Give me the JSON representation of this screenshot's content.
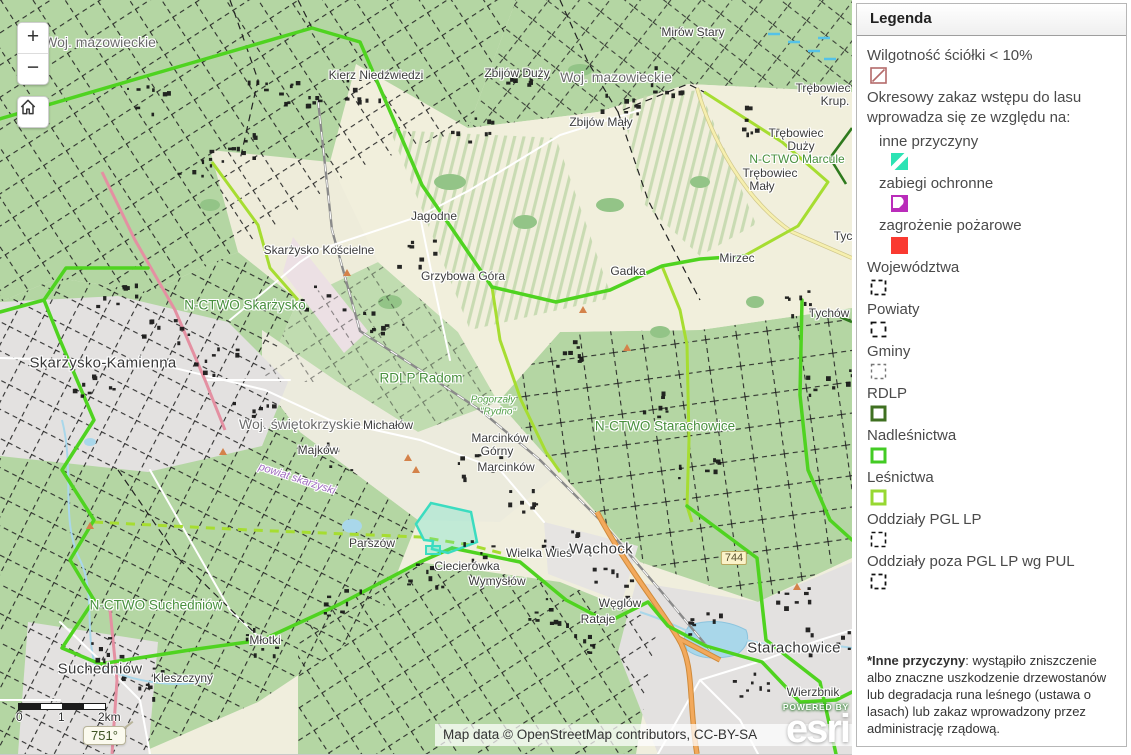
{
  "map": {
    "controls": {
      "zoom_in_label": "+",
      "zoom_out_label": "−"
    },
    "scalebar": {
      "ticks": [
        "0",
        "1",
        "2km"
      ]
    },
    "readout": "751°",
    "attribution": "Map data © OpenStreetMap contributors, CC-BY-SA",
    "powered_by": "POWERED BY",
    "brand": "esri",
    "labels": [
      {
        "text": "Woj. mazowieckie",
        "x": 100,
        "y": 42,
        "cls": "admin"
      },
      {
        "text": "Mirów Stary",
        "x": 693,
        "y": 32,
        "cls": "place"
      },
      {
        "text": "Kierz Niedźwiedzi",
        "x": 376,
        "y": 75,
        "cls": "place"
      },
      {
        "text": "Zbijów Duży",
        "x": 517,
        "y": 73,
        "cls": "place"
      },
      {
        "text": "Woj. mazowieckie",
        "x": 616,
        "y": 77,
        "cls": "admin"
      },
      {
        "text": "Zbijów Mały",
        "x": 601,
        "y": 122,
        "cls": "place"
      },
      {
        "text": "Trębowiec",
        "x": 823,
        "y": 88,
        "cls": "place"
      },
      {
        "text": "Krup.",
        "x": 835,
        "y": 101,
        "cls": "place"
      },
      {
        "text": "Trębowiec",
        "x": 796,
        "y": 133,
        "cls": "place"
      },
      {
        "text": "Duży",
        "x": 801,
        "y": 146,
        "cls": "place"
      },
      {
        "text": "N-CTWO Marcule",
        "x": 797,
        "y": 159,
        "cls": "forest"
      },
      {
        "text": "Trębowiec",
        "x": 770,
        "y": 173,
        "cls": "place"
      },
      {
        "text": "Mały",
        "x": 762,
        "y": 186,
        "cls": "place"
      },
      {
        "text": "Jagodne",
        "x": 434,
        "y": 216,
        "cls": "place"
      },
      {
        "text": "Tyc",
        "x": 843,
        "y": 236,
        "cls": "place"
      },
      {
        "text": "Skarżysko Kościelne",
        "x": 319,
        "y": 250,
        "cls": "place"
      },
      {
        "text": "Mirzec",
        "x": 737,
        "y": 258,
        "cls": "place"
      },
      {
        "text": "Gadka",
        "x": 628,
        "y": 271,
        "cls": "place"
      },
      {
        "text": "Grzybowa Góra",
        "x": 463,
        "y": 276,
        "cls": "place"
      },
      {
        "text": "N-CTWO Skarżysko",
        "x": 245,
        "y": 305,
        "cls": "forest-lg"
      },
      {
        "text": "Tychów",
        "x": 829,
        "y": 313,
        "cls": "place"
      },
      {
        "text": "Skarżysko-Kamienna",
        "x": 103,
        "y": 363,
        "cls": "city"
      },
      {
        "text": "RDLP Radom",
        "x": 421,
        "y": 378,
        "cls": "forest-lg"
      },
      {
        "text": "Pogorzały",
        "x": 493,
        "y": 400,
        "cls": "reserve"
      },
      {
        "text": "\"Rydno\"",
        "x": 498,
        "y": 412,
        "cls": "reserve"
      },
      {
        "text": "Woj. świętokrzyskie",
        "x": 300,
        "y": 424,
        "cls": "admin"
      },
      {
        "text": "Michałów",
        "x": 388,
        "y": 425,
        "cls": "place"
      },
      {
        "text": "N-CTWO Starachowice",
        "x": 665,
        "y": 426,
        "cls": "forest-lg"
      },
      {
        "text": "Marcinków",
        "x": 500,
        "y": 438,
        "cls": "place"
      },
      {
        "text": "Górny",
        "x": 497,
        "y": 451,
        "cls": "place"
      },
      {
        "text": "Majków",
        "x": 318,
        "y": 450,
        "cls": "place"
      },
      {
        "text": "Marcinków",
        "x": 506,
        "y": 467,
        "cls": "place"
      },
      {
        "text": "powiat skarżyski",
        "x": 297,
        "y": 479,
        "cls": "powiat",
        "rot": 18
      },
      {
        "text": "Parszów",
        "x": 372,
        "y": 543,
        "cls": "place"
      },
      {
        "text": "Wielka Wieś",
        "x": 539,
        "y": 553,
        "cls": "place"
      },
      {
        "text": "Wąchock",
        "x": 601,
        "y": 549,
        "cls": "city"
      },
      {
        "text": "Ciecierówka",
        "x": 467,
        "y": 566,
        "cls": "place"
      },
      {
        "text": "Wymysłów",
        "x": 497,
        "y": 581,
        "cls": "place"
      },
      {
        "text": "N-CTWO Suchedniów",
        "x": 156,
        "y": 605,
        "cls": "forest-lg"
      },
      {
        "text": "Węglów",
        "x": 620,
        "y": 603,
        "cls": "place"
      },
      {
        "text": "Rataje",
        "x": 598,
        "y": 619,
        "cls": "place"
      },
      {
        "text": "Młotki",
        "x": 265,
        "y": 640,
        "cls": "place"
      },
      {
        "text": "Suchedniów",
        "x": 100,
        "y": 669,
        "cls": "city"
      },
      {
        "text": "Kleszczyny",
        "x": 183,
        "y": 678,
        "cls": "place"
      },
      {
        "text": "Starachowice",
        "x": 794,
        "y": 648,
        "cls": "city"
      },
      {
        "text": "Wierzbnik",
        "x": 813,
        "y": 692,
        "cls": "place"
      },
      {
        "text": "744",
        "x": 734,
        "y": 558,
        "cls": "shield"
      }
    ]
  },
  "legend": {
    "title": "Legenda",
    "items": [
      {
        "label": "Wilgotność ściółki < 10%",
        "swatch": {
          "kind": "diag-line",
          "color": "#b46a6a"
        }
      },
      {
        "label": "Okresowy zakaz wstępu do lasu wprowadza się ze względu na:",
        "swatch": null
      },
      {
        "label": "inne przyczyny",
        "indent": true,
        "swatch": {
          "kind": "stripe",
          "color": "#2ce3b4"
        }
      },
      {
        "label": "zabiegi ochronne",
        "indent": true,
        "swatch": {
          "kind": "corner",
          "color": "#ba2cba"
        }
      },
      {
        "label": "zagrożenie pożarowe",
        "indent": true,
        "swatch": {
          "kind": "fill",
          "color": "#fa3a31"
        }
      },
      {
        "label": "Województwa",
        "swatch": {
          "kind": "dashed",
          "color": "#111111",
          "dash": "4 3",
          "width": 1.8
        }
      },
      {
        "label": "Powiaty",
        "swatch": {
          "kind": "dashed",
          "color": "#111111",
          "dash": "5 4",
          "width": 1.8
        }
      },
      {
        "label": "Gminy",
        "swatch": {
          "kind": "dashed",
          "color": "#777777",
          "dash": "3 3",
          "width": 1.4
        }
      },
      {
        "label": "RDLP",
        "swatch": {
          "kind": "outline",
          "color": "#3f7021"
        }
      },
      {
        "label": "Nadleśnictwa",
        "swatch": {
          "kind": "outline",
          "color": "#43cb24"
        }
      },
      {
        "label": "Leśnictwa",
        "swatch": {
          "kind": "outline",
          "color": "#97d832"
        }
      },
      {
        "label": "Oddziały PGL LP",
        "swatch": {
          "kind": "dashed",
          "color": "#111111",
          "dash": "4 3",
          "width": 1.6
        }
      },
      {
        "label": "Oddziały poza PGL LP wg PUL",
        "swatch": {
          "kind": "dashed",
          "color": "#111111",
          "dash": "4 3",
          "width": 1.8
        }
      }
    ],
    "footnote_bold": "*Inne przyczyny",
    "footnote_rest": ": wystąpiło zniszczenie albo znaczne uszkodzenie drzewostanów lub degradacja runa leśnego (ustawa o lasach) lub zakaz wprowadzony przez administrację rządową."
  }
}
